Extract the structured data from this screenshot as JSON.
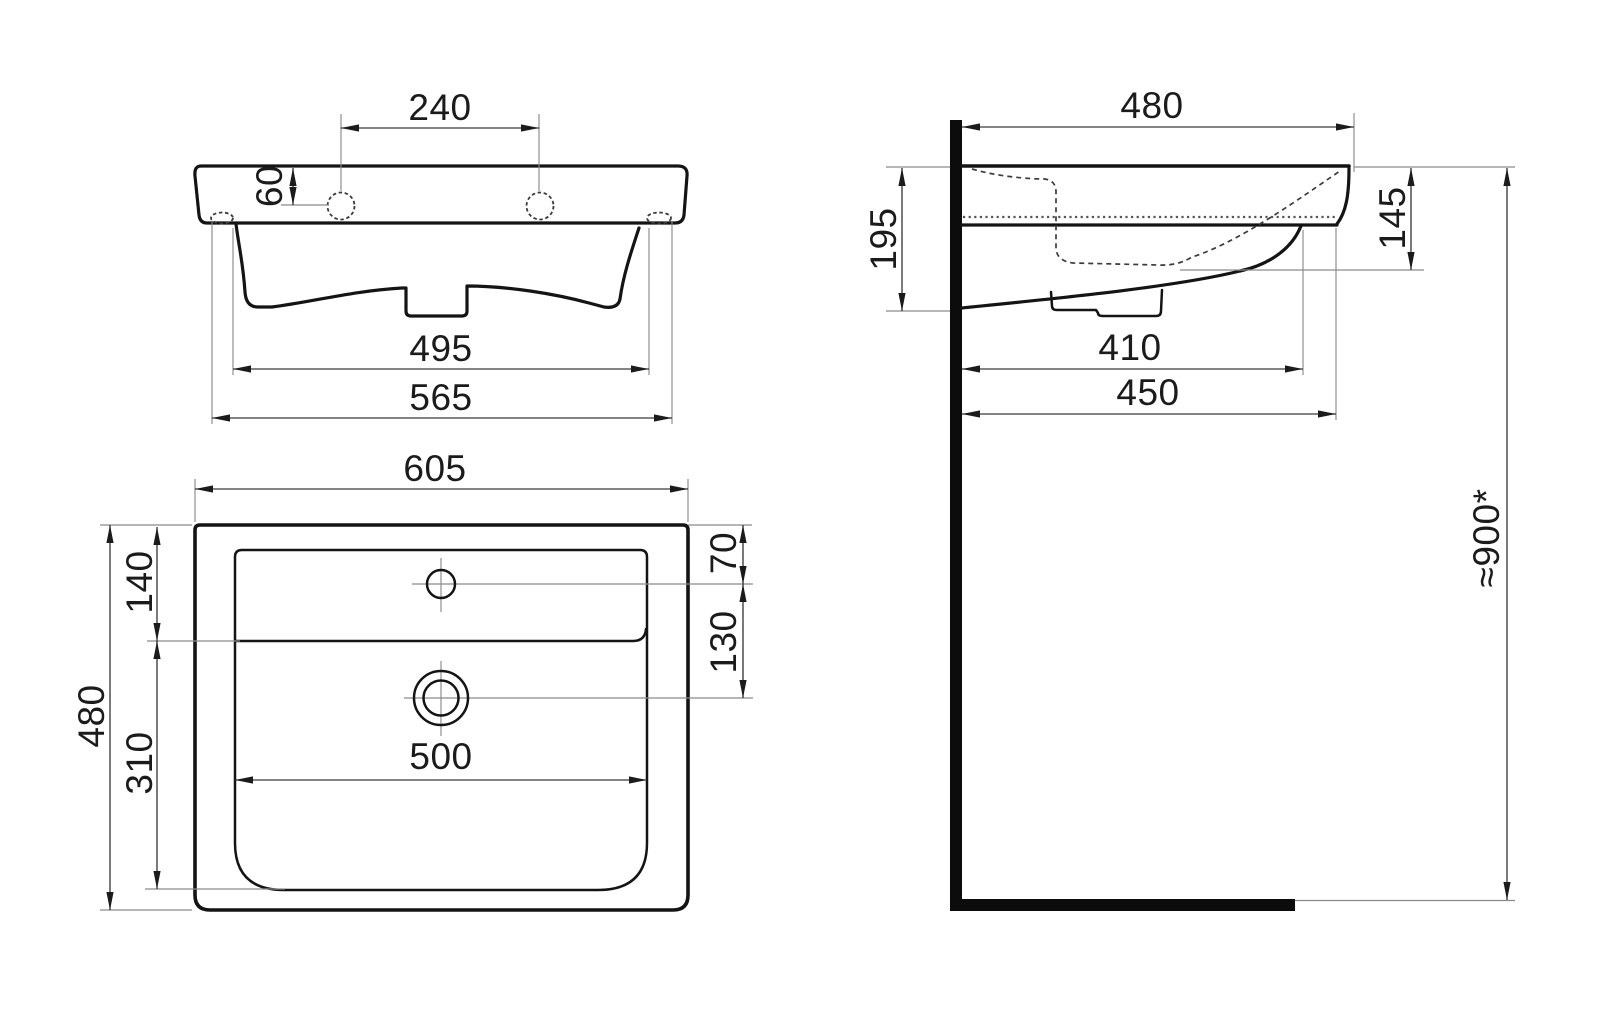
{
  "drawing": {
    "type": "washbasin-technical-drawing",
    "colors": {
      "background": "#ffffff",
      "line": "#141414",
      "dim_line": "#3a3a3a"
    },
    "views": {
      "front": "front-elevation",
      "side": "side-section-with-wall",
      "plan": "top-plan"
    }
  },
  "dims": {
    "front": {
      "hole_spacing": "240",
      "hole_height": "60",
      "pedestal_width": "495",
      "bottom_width": "565"
    },
    "side": {
      "depth": "480",
      "back_height": "195",
      "front_height": "145",
      "underside_depth": "410",
      "lower_depth": "450",
      "install_height": "≈900*"
    },
    "plan": {
      "width": "605",
      "depth": "480",
      "deck_depth": "140",
      "bowl_depth": "310",
      "hole_offset": "70",
      "hole_to_drain": "130",
      "bowl_width": "500"
    }
  }
}
